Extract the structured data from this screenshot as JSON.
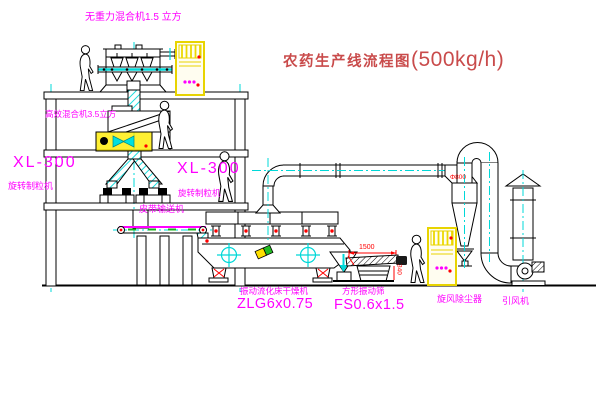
{
  "title": {
    "prefix": "农药生产线流程图",
    "capacity": "(500kg/h)"
  },
  "labels": {
    "gravity_mixer": "无重力混合机1.5 立方",
    "high_eff_mixer": "高效混合机3.5立方",
    "granulator_model_1": "XL-300",
    "granulator_name_1": "旋转制粒机",
    "granulator_model_2": "XL-300",
    "granulator_name_2": "旋转制粒机",
    "belt_conveyor": "皮带输送机",
    "dryer_name": "振动流化床干燥机",
    "dryer_model": "ZLG6x0.75",
    "sieve_name": "方形振动筛",
    "sieve_model": "FS0.6x1.5",
    "cyclone": "旋风除尘器",
    "fan": "引风机"
  },
  "dimensions": {
    "sieve_length": "1500",
    "sieve_height": "340",
    "cyclone_diameter": "Φ800"
  },
  "colors": {
    "line": "#000000",
    "label_magenta": "#ff00ff",
    "centerline_cyan": "#00d8d8",
    "cabinet_yellow": "#ecd900",
    "dimension_red": "#ff0000",
    "title_red": "#c94b4b",
    "background": "#ffffff"
  }
}
